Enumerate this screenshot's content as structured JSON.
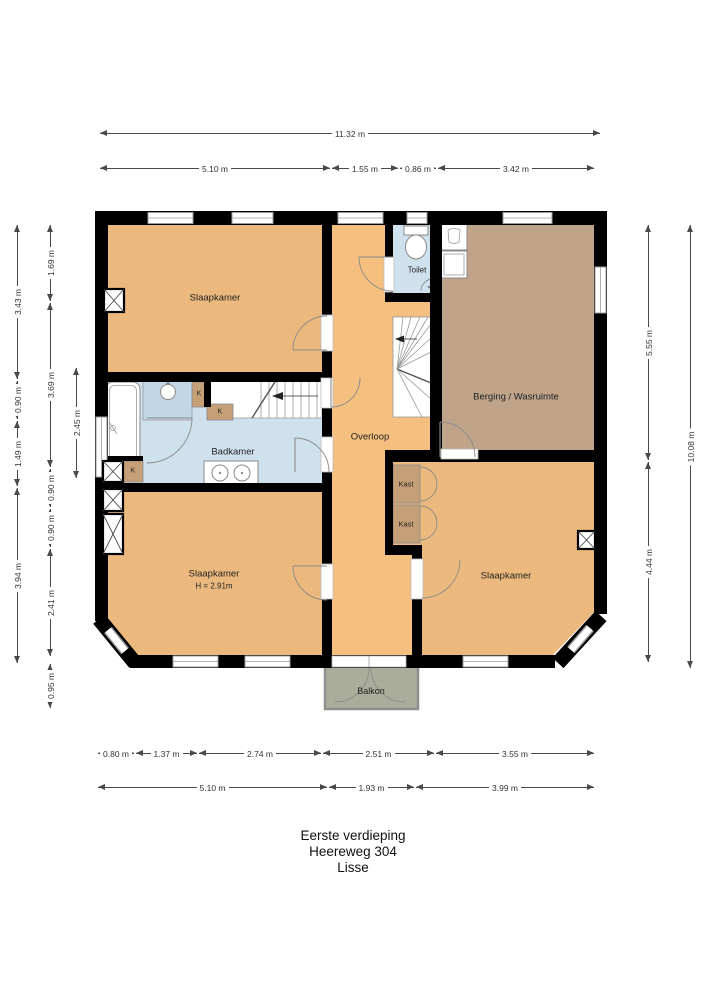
{
  "title": {
    "line1": "Eerste verdieping",
    "line2": "Heereweg 304",
    "line3": "Lisse"
  },
  "colors": {
    "wall": "#000000",
    "room_orange": "#ebb97d",
    "hall_orange": "#f5c07f",
    "storage_brown": "#bfa489",
    "closet_tan": "#c5a077",
    "bathroom_blue": "#d0e1ee",
    "shower_blue": "#c2d7e6",
    "balcony_green": "#abad9b",
    "dimension_gray": "#4a4a4a"
  },
  "rooms": [
    {
      "id": "slaapkamer-tl",
      "label": "Slaapkamer",
      "x": 215,
      "y": 298,
      "fs": 9.5
    },
    {
      "id": "toilet",
      "label": "Toilet",
      "x": 417,
      "y": 270,
      "fs": 8
    },
    {
      "id": "berging-wasruimte",
      "label": "Berging / Wasruimte",
      "x": 516,
      "y": 397,
      "fs": 9.5
    },
    {
      "id": "overloop",
      "label": "Overloop",
      "x": 370,
      "y": 437,
      "fs": 9.5
    },
    {
      "id": "badkamer",
      "label": "Badkamer",
      "x": 233,
      "y": 452,
      "fs": 9.5
    },
    {
      "id": "slaapkamer-bl",
      "label": "Slaapkamer",
      "sub": "H = 2.91m",
      "x": 214,
      "y": 574,
      "fs": 9.5
    },
    {
      "id": "slaapkamer-br",
      "label": "Slaapkamer",
      "x": 506,
      "y": 576,
      "fs": 9.5
    },
    {
      "id": "kast-1",
      "label": "Kast",
      "x": 406,
      "y": 484,
      "fs": 7.5
    },
    {
      "id": "kast-2",
      "label": "Kast",
      "x": 406,
      "y": 524,
      "fs": 7.5
    },
    {
      "id": "closet-k-1",
      "label": "K",
      "x": 199,
      "y": 394,
      "fs": 7
    },
    {
      "id": "closet-k-2",
      "label": "K",
      "x": 220,
      "y": 412,
      "fs": 7
    },
    {
      "id": "closet-k-3",
      "label": "K",
      "x": 133,
      "y": 471,
      "fs": 7
    },
    {
      "id": "balkon",
      "label": "Balkon",
      "x": 371,
      "y": 691,
      "fs": 9
    }
  ],
  "dimensions": {
    "horizontal": [
      {
        "label": "11.32 m",
        "x1": 100,
        "x2": 600,
        "y": 133
      },
      {
        "label": "5.10 m",
        "x1": 100,
        "x2": 330,
        "y": 168
      },
      {
        "label": "1.55 m",
        "x1": 332,
        "x2": 398,
        "y": 168
      },
      {
        "label": "0.86 m",
        "x1": 400,
        "x2": 436,
        "y": 168
      },
      {
        "label": "3.42 m",
        "x1": 438,
        "x2": 594,
        "y": 168
      },
      {
        "label": "0.80 m",
        "x1": 98,
        "x2": 134,
        "y": 753
      },
      {
        "label": "1.37 m",
        "x1": 136,
        "x2": 197,
        "y": 753
      },
      {
        "label": "2.74 m",
        "x1": 199,
        "x2": 321,
        "y": 753
      },
      {
        "label": "2.51 m",
        "x1": 323,
        "x2": 434,
        "y": 753
      },
      {
        "label": "3.55 m",
        "x1": 436,
        "x2": 594,
        "y": 753
      },
      {
        "label": "5.10 m",
        "x1": 98,
        "x2": 327,
        "y": 787
      },
      {
        "label": "1.93 m",
        "x1": 329,
        "x2": 414,
        "y": 787
      },
      {
        "label": "3.99 m",
        "x1": 416,
        "x2": 594,
        "y": 787
      }
    ],
    "vertical": [
      {
        "label": "3.43 m",
        "y1": 225,
        "y2": 379,
        "x": 17
      },
      {
        "label": "0.90 m",
        "y1": 381,
        "y2": 419,
        "x": 17
      },
      {
        "label": "1.49 m",
        "y1": 421,
        "y2": 486,
        "x": 17
      },
      {
        "label": "3.94 m",
        "y1": 488,
        "y2": 663,
        "x": 17
      },
      {
        "label": "1.69 m",
        "y1": 225,
        "y2": 301,
        "x": 50
      },
      {
        "label": "3.69 m",
        "y1": 303,
        "y2": 467,
        "x": 50
      },
      {
        "label": "0.90 m",
        "y1": 469,
        "y2": 507,
        "x": 50
      },
      {
        "label": "0.90 m",
        "y1": 509,
        "y2": 547,
        "x": 50
      },
      {
        "label": "2.41 m",
        "y1": 549,
        "y2": 656,
        "x": 50
      },
      {
        "label": "0.95 m",
        "y1": 664,
        "y2": 708,
        "x": 50
      },
      {
        "label": "2.45 m",
        "y1": 368,
        "y2": 478,
        "x": 76
      },
      {
        "label": "5.55 m",
        "y1": 225,
        "y2": 460,
        "x": 648
      },
      {
        "label": "4.44 m",
        "y1": 462,
        "y2": 662,
        "x": 648
      },
      {
        "label": "10.08 m",
        "y1": 225,
        "y2": 668,
        "x": 690
      }
    ]
  }
}
